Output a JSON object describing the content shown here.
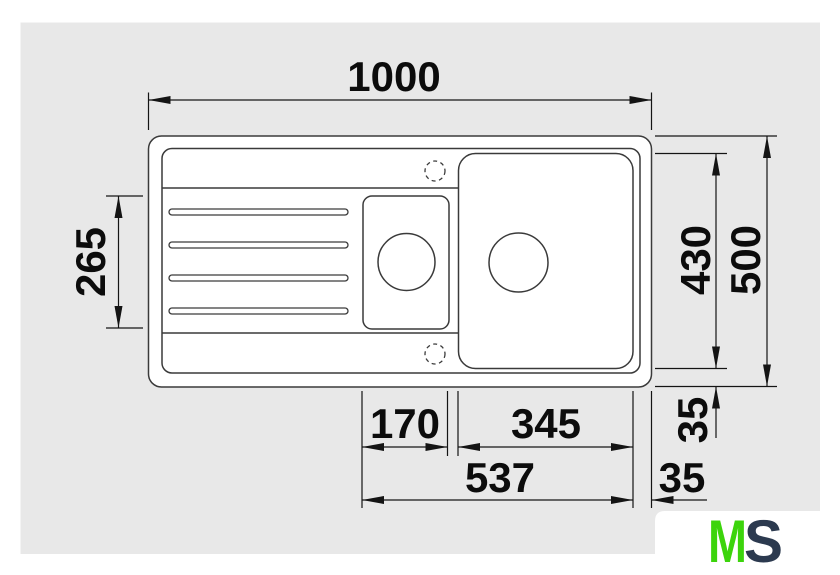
{
  "drawing": {
    "title": "sink-top-view-dimensional-drawing",
    "background_color": "#e8e8e8",
    "line_color": "#3a3a3a",
    "dimension_color": "#141414",
    "dimensions": {
      "overall_width": "1000",
      "overall_depth": "500",
      "bowl_depth": "430",
      "drainboard_recess_depth": "265",
      "small_bowl_width": "170",
      "main_bowl_width": "345",
      "bowls_total_width": "537",
      "edge_offset_vertical": "35",
      "edge_offset_horizontal": "35"
    },
    "logo": {
      "letter_m": "M",
      "letter_s": "S",
      "m_color": "#3cd40c",
      "s_color": "#2c3a4f"
    }
  }
}
